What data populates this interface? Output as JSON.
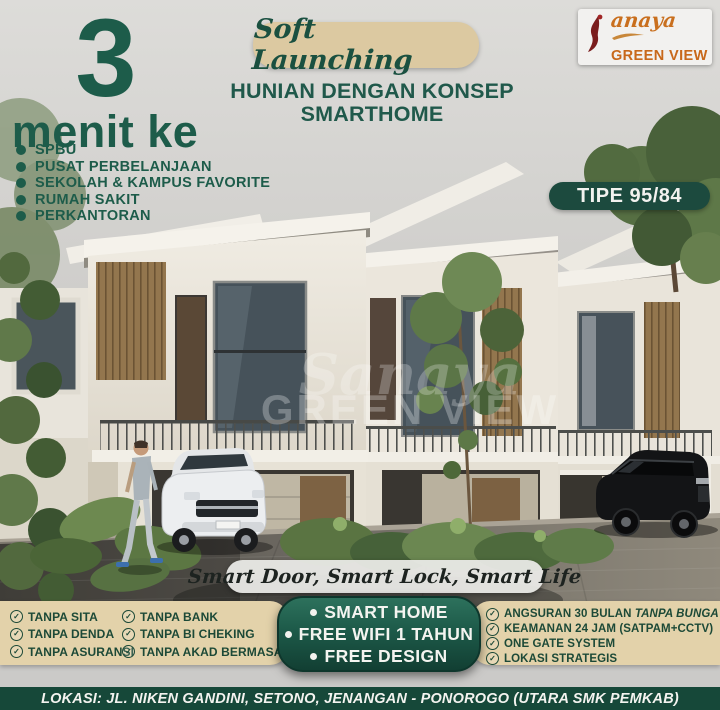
{
  "brand": {
    "script": "anaya",
    "caps": "GREEN VIEW"
  },
  "header": {
    "soft_launching": "Soft Launching",
    "tagline_line1": "HUNIAN DENGAN KONSEP",
    "tagline_line2": "SMARTHOME",
    "type_badge": "TIPE 95/84"
  },
  "proximity": {
    "number": "3",
    "label": "menit ke",
    "items": [
      "SPBU",
      "PUSAT PERBELANJAAN",
      "SEKOLAH & KAMPUS FAVORITE",
      "RUMAH SAKIT",
      "PERKANTORAN"
    ]
  },
  "hero": {
    "watermark_script": "Sanaya",
    "watermark_caps": "GREEN VIEW",
    "banner": "Smart Door, Smart Lock, Smart Life"
  },
  "benefits": {
    "left_col1": [
      "TANPA SITA",
      "TANPA DENDA",
      "TANPA ASURANSI"
    ],
    "left_col2": [
      "TANPA BANK",
      "TANPA BI CHEKING",
      "TANPA AKAD BERMASALAH"
    ],
    "center": [
      "SMART HOME",
      "FREE WIFI 1 TAHUN",
      "FREE DESIGN"
    ],
    "right": [
      {
        "pre": "ANGSURAN 30 BULAN ",
        "em": "TANPA BUNGA"
      },
      {
        "pre": "KEAMANAN 24 JAM (SATPAM+CCTV)",
        "em": ""
      },
      {
        "pre": "ONE GATE SYSTEM",
        "em": ""
      },
      {
        "pre": "LOKASI STRATEGIS",
        "em": ""
      }
    ]
  },
  "footer": {
    "location": "LOKASI: JL. NIKEN GANDINI, SETONO, JENANGAN - PONOROGO (UTARA SMK PEMKAB)"
  },
  "colors": {
    "accent_green": "#1d5c4a",
    "badge_green": "#1c4a3e",
    "beige": "#e3d2aa",
    "bar_green": "#164839",
    "logo_orange": "#c8681a",
    "logo_maroon": "#7a1d1d"
  }
}
